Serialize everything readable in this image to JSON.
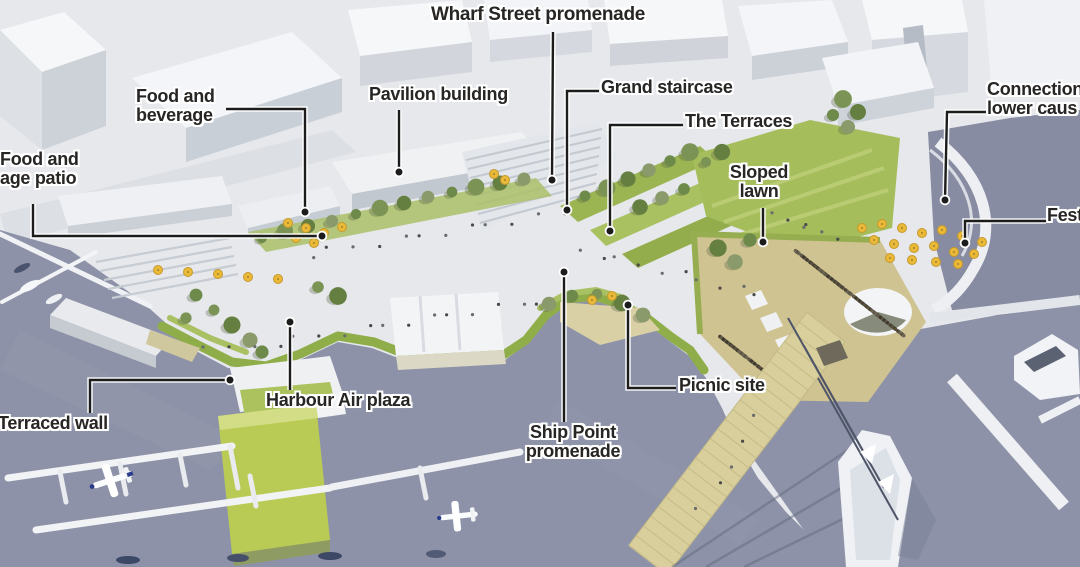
{
  "callouts": {
    "wharf_street_promenade": {
      "line1": "Wharf Street promenade"
    },
    "food_and_beverage": {
      "line1": "Food and",
      "line2": "beverage"
    },
    "pavilion_building": {
      "line1": "Pavilion building"
    },
    "grand_staircase": {
      "line1": "Grand staircase"
    },
    "the_terraces": {
      "line1": "The Terraces"
    },
    "sloped_lawn": {
      "line1": "Sloped",
      "line2": "lawn"
    },
    "connection_lower_causeway": {
      "line1": "Connection",
      "line2": "lower caus"
    },
    "festival": {
      "line1": "Fest"
    },
    "food_and_beverage_patio": {
      "line1": "Food and",
      "line2": "age patio"
    },
    "terraced_wall": {
      "line1": "Terraced wall"
    },
    "harbour_air_plaza": {
      "line1": "Harbour Air plaza"
    },
    "ship_point_promenade": {
      "line1": "Ship Point",
      "line2": "promenade"
    },
    "picnic_site": {
      "line1": "Picnic site"
    }
  },
  "palette": {
    "water": "#8d92a8",
    "lawn_green": "#9fb654",
    "tree_green": "#73885c",
    "building_white": "#f4f5f7",
    "building_shade": "#ccd1d8",
    "pier_tan": "#d8ce9a",
    "festival_ground": "#d0c392",
    "umbrella_yellow": "#e9b93a",
    "harbour_air_roof": "#b9cb55",
    "label_text": "#272624",
    "leader_line": "#1c1c1c"
  }
}
